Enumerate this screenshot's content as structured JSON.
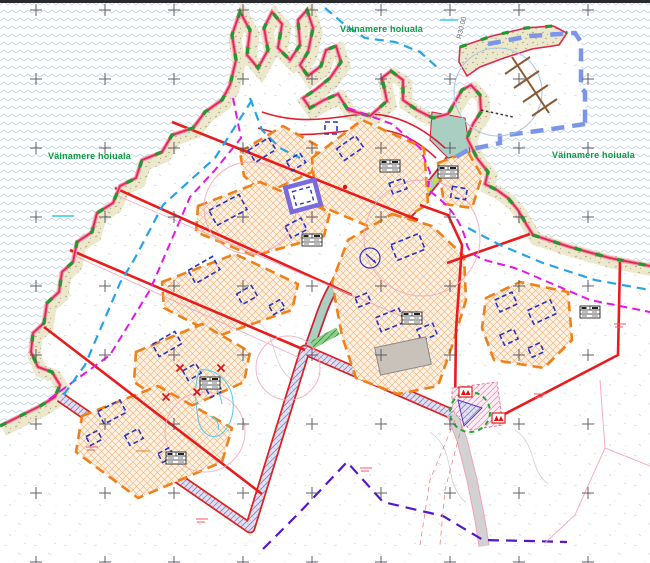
{
  "map": {
    "type": "detail-plan-map",
    "area_labels": [
      {
        "id": "hoiuala-top",
        "text": "Väinamere hoiuala"
      },
      {
        "id": "hoiuala-left",
        "text": "Väinamere hoiuala"
      },
      {
        "id": "hoiuala-right",
        "text": "Väinamere hoiuala"
      }
    ],
    "annotations": [
      {
        "id": "radius-label",
        "text": "R30.00"
      }
    ],
    "colors": {
      "sea_pattern": "#c6d7ea",
      "shore_strip": "#ece8cc",
      "coastline": "#dd2b50",
      "coast_halo": "#f591ad",
      "protected_area_dash": "#1f9a2e",
      "plot_boundary": "#e81c1c",
      "building_envelope": "#f08018",
      "planned_building": "#2a35c0",
      "existing_building_fill": "#c9c2ba",
      "existing_building_outline": "#7a6ae0",
      "harbor_boundary": "#7b96e8",
      "pier": "#8a5a33",
      "road_fill": "#a8cfc2",
      "road_corridor_hatch": "#8585c8",
      "utility_magenta": "#e515e5",
      "utility_cyan": "#29a3e8",
      "cable_purple": "#5517cc",
      "radius_arc_pink": "#f2a7bc",
      "label_green": "#0a9c3f"
    }
  }
}
